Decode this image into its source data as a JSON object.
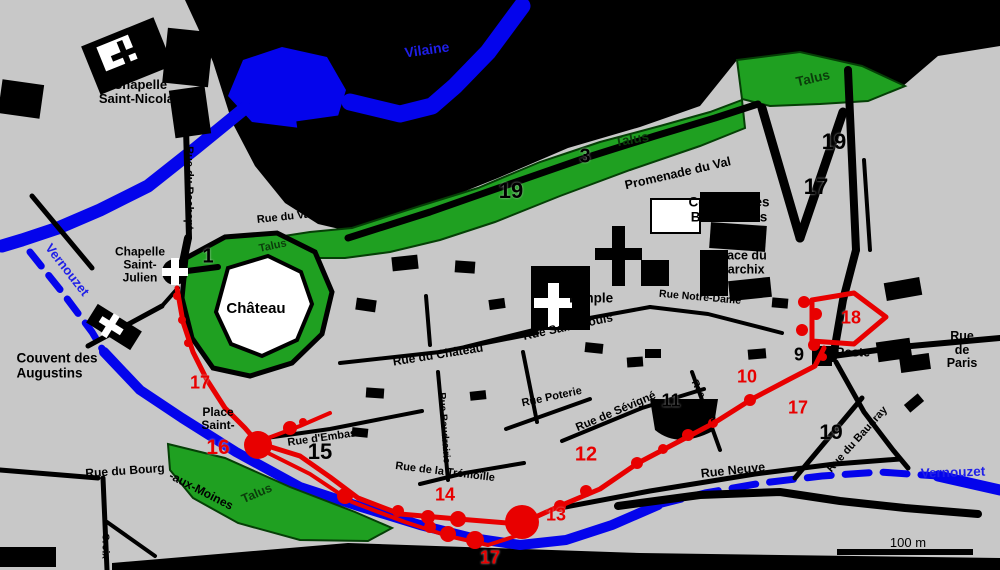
{
  "colors": {
    "background": "#c8c8c8",
    "water_blue": "#0404ec",
    "talus_green": "#1fa021",
    "wall_red": "#e80000",
    "road_black": "#000000"
  },
  "labels": {
    "vilaine": "Vilaine",
    "vernouzet": "Vernouzet",
    "chapelle_saint_nicolas": "Chapelle\nSaint-Nicolas",
    "rue_du_rachapt": "Rue du Rachapt",
    "talus": "Talus",
    "promenade_du_val": "Promenade du Val",
    "rue_du_val": "Rue du Val",
    "couvent_benedictins": "Couvent des\nBénédictins",
    "place_du_marchix": "Place du\nMarchix",
    "temple": "Temple",
    "rue_saint_louis": "Rue Saint-Louis",
    "rue_du_chateau": "Rue du Château",
    "chateau": "Château",
    "chapelle_saint_julien": "Chapelle\nSaint-\nJulien",
    "couvent_augustins": "Couvent des\nAugustins",
    "place_saint": "Place\nSaint-",
    "rue_d_embas": "Rue d'Embas",
    "rue_du_bourg": "Rue du Bourg",
    "aux_moines": "-aux-Moines",
    "rue_tremoille": "Rue de la Trémoïlle",
    "rue_poterie": "Rue Poterie",
    "rue_sevigne": "Rue de Sévigné",
    "rue_neuve": "Rue Neuve",
    "rue_notre_dame": "Rue Notre-Dame",
    "rue_baudrairie": "Rue Baudrairie",
    "rue_de_la": "Rue de la",
    "rue_du_baudray": "Rue du Baudray",
    "poste": "Poste",
    "rue_de_paris": "Rue de\nParis",
    "croix": "Croix",
    "scale_100m": "100 m"
  },
  "numbers": {
    "n1": "1",
    "n3": "3",
    "n9": "9",
    "n10": "10",
    "n11": "11",
    "n12": "12",
    "n13": "13",
    "n14": "14",
    "n15": "15",
    "n16": "16",
    "n17": "17",
    "n18": "18",
    "n19": "19"
  }
}
